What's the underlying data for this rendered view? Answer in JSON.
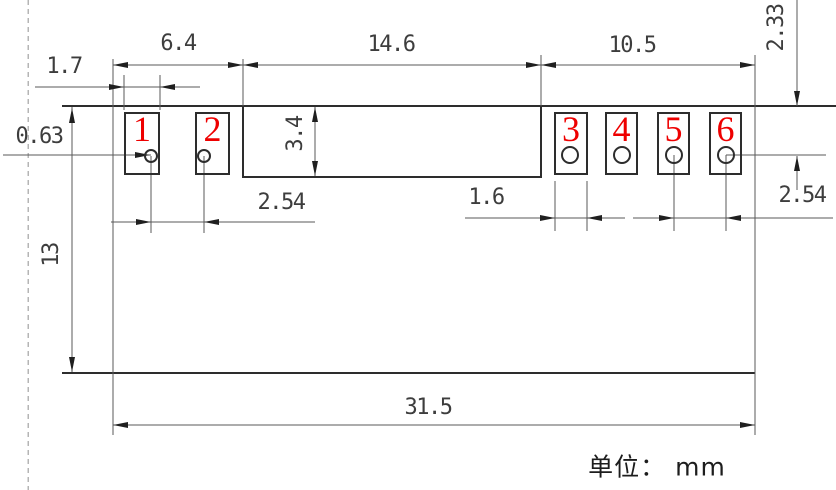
{
  "drawing": {
    "unit_note": "单位： mm",
    "pads": [
      {
        "number": "1"
      },
      {
        "number": "2"
      },
      {
        "number": "3"
      },
      {
        "number": "4"
      },
      {
        "number": "5"
      },
      {
        "number": "6"
      }
    ],
    "dimensions": {
      "left_pad_width": "1.7",
      "left_group_width": "6.4",
      "body_width": "14.6",
      "right_group_width": "10.5",
      "top_clearance": "2.33",
      "hole_diameter": "0.63",
      "body_height": "3.4",
      "left_pitch": "2.54",
      "right_pad_width": "1.6",
      "right_pitch": "2.54",
      "board_height": "13",
      "overall_width": "31.5"
    },
    "colors": {
      "outline": "#2d2d2d",
      "dimension_line": "#5a5a5a",
      "pad_number": "#ee0000",
      "dashed_reference": "#b5b5b5"
    }
  }
}
